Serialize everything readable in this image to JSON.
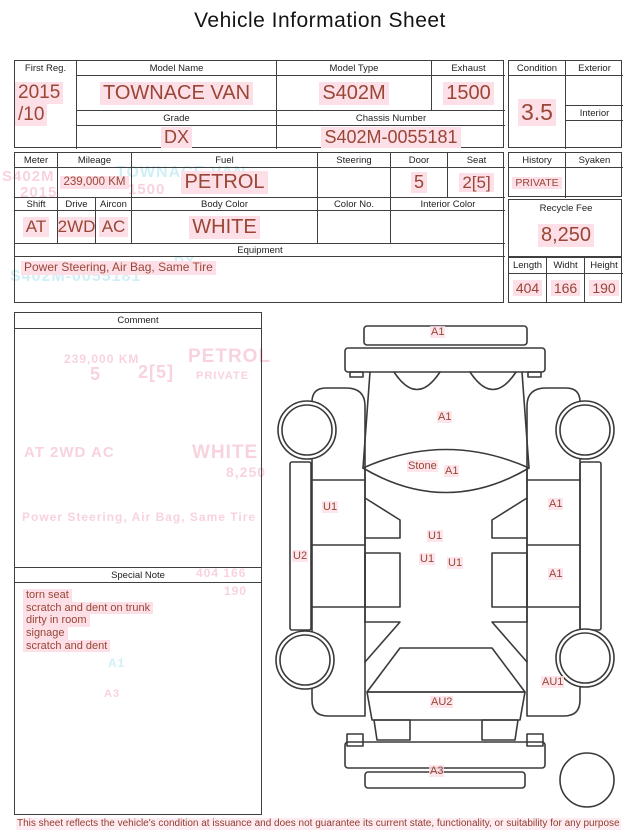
{
  "title": "Vehicle Information Sheet",
  "top_table": {
    "first_reg": {
      "label": "First Reg.",
      "value_line1": "2015",
      "value_line2": "/10"
    },
    "model_name": {
      "label": "Model Name",
      "value": "TOWNACE VAN"
    },
    "model_type": {
      "label": "Model Type",
      "value": "S402M"
    },
    "exhaust": {
      "label": "Exhaust",
      "value": "1500"
    },
    "grade": {
      "label": "Grade",
      "value": "DX"
    },
    "chassis_number": {
      "label": "Chassis Number",
      "value": "S402M-0055181"
    },
    "condition": {
      "label": "Condition",
      "value": "3.5"
    },
    "exterior": {
      "label": "Exterior",
      "value": ""
    },
    "interior": {
      "label": "Interior",
      "value": ""
    }
  },
  "spec_table": {
    "meter": {
      "label": "Meter",
      "value": ""
    },
    "mileage": {
      "label": "Mileage",
      "value": "239,000 KM"
    },
    "fuel": {
      "label": "Fuel",
      "value": "PETROL"
    },
    "steering": {
      "label": "Steering",
      "value": ""
    },
    "door": {
      "label": "Door",
      "value": "5"
    },
    "seat": {
      "label": "Seat",
      "value": "2[5]"
    },
    "shift": {
      "label": "Shift",
      "value": "AT"
    },
    "drive": {
      "label": "Drive",
      "value": "2WD"
    },
    "aircon": {
      "label": "Aircon",
      "value": "AC"
    },
    "body_color": {
      "label": "Body Color",
      "value": "WHITE"
    },
    "color_no": {
      "label": "Color No.",
      "value": ""
    },
    "interior_color": {
      "label": "Interior Color",
      "value": ""
    },
    "equipment": {
      "label": "Equipment",
      "value": "Power Steering, Air Bag, Same Tire"
    }
  },
  "right_table": {
    "history": {
      "label": "History",
      "value": "PRIVATE"
    },
    "syaken": {
      "label": "Syaken",
      "value": ""
    },
    "recycle_fee": {
      "label": "Recycle Fee",
      "value": "8,250"
    },
    "length": {
      "label": "Length",
      "value": "404"
    },
    "width": {
      "label": "Widht",
      "value": "166"
    },
    "height": {
      "label": "Height",
      "value": "190"
    }
  },
  "comment": {
    "label": "Comment"
  },
  "special_note": {
    "label": "Special Note",
    "items": [
      "torn seat",
      "scratch and dent on trunk",
      "dirty in room",
      "signage",
      "scratch and dent"
    ]
  },
  "diagram": {
    "labels": [
      {
        "text": "A1",
        "x": 160,
        "y": 16
      },
      {
        "text": "A1",
        "x": 167,
        "y": 101
      },
      {
        "text": "Stone",
        "x": 137,
        "y": 150
      },
      {
        "text": "A1",
        "x": 174,
        "y": 155
      },
      {
        "text": "U1",
        "x": 52,
        "y": 191
      },
      {
        "text": "A1",
        "x": 278,
        "y": 188
      },
      {
        "text": "U1",
        "x": 157,
        "y": 220
      },
      {
        "text": "U1",
        "x": 149,
        "y": 243
      },
      {
        "text": "U1",
        "x": 177,
        "y": 247
      },
      {
        "text": "U2",
        "x": 22,
        "y": 240
      },
      {
        "text": "A1",
        "x": 278,
        "y": 258
      },
      {
        "text": "AU1",
        "x": 271,
        "y": 366
      },
      {
        "text": "AU2",
        "x": 160,
        "y": 386
      },
      {
        "text": "A3",
        "x": 159,
        "y": 455
      }
    ]
  },
  "ghost_lines": [
    {
      "text": "S402M",
      "x": 2,
      "y": 168,
      "size": 15,
      "color": "pink"
    },
    {
      "text": "2015",
      "x": 20,
      "y": 184,
      "size": 15,
      "color": "pink"
    },
    {
      "text": "TOWNACE VAN",
      "x": 116,
      "y": 164,
      "size": 16,
      "color": "cyan"
    },
    {
      "text": "1500",
      "x": 128,
      "y": 181,
      "size": 15,
      "color": "pink"
    },
    {
      "text": "DX",
      "x": 174,
      "y": 253,
      "size": 14,
      "color": "cyan"
    },
    {
      "text": "S402M-0055181",
      "x": 10,
      "y": 268,
      "size": 16,
      "color": "cyan"
    },
    {
      "text": "239,000 KM",
      "x": 64,
      "y": 352,
      "size": 12,
      "color": "pink"
    },
    {
      "text": "5",
      "x": 90,
      "y": 364,
      "size": 18,
      "color": "pink"
    },
    {
      "text": "2[5]",
      "x": 138,
      "y": 362,
      "size": 18,
      "color": "pink"
    },
    {
      "text": "PETROL",
      "x": 188,
      "y": 346,
      "size": 19,
      "color": "pink"
    },
    {
      "text": "PRIVATE",
      "x": 196,
      "y": 370,
      "size": 11,
      "color": "pink"
    },
    {
      "text": "AT  2WD  AC",
      "x": 24,
      "y": 444,
      "size": 15,
      "color": "pink"
    },
    {
      "text": "WHITE",
      "x": 192,
      "y": 442,
      "size": 19,
      "color": "pink"
    },
    {
      "text": "8,250",
      "x": 226,
      "y": 464,
      "size": 14,
      "color": "pink"
    },
    {
      "text": "Power Steering, Air Bag, Same Tire",
      "x": 22,
      "y": 510,
      "size": 12,
      "color": "pink"
    },
    {
      "text": "404  166",
      "x": 196,
      "y": 566,
      "size": 12,
      "color": "pink"
    },
    {
      "text": "190",
      "x": 224,
      "y": 584,
      "size": 12,
      "color": "pink"
    },
    {
      "text": "A1",
      "x": 108,
      "y": 656,
      "size": 12,
      "color": "cyan"
    },
    {
      "text": "A3",
      "x": 104,
      "y": 688,
      "size": 11,
      "color": "pink"
    }
  ],
  "footer": {
    "disclaimer": "This sheet reflects the vehicle's condition at issuance and does not guarantee its current state, functionality, or suitability for any purpose"
  },
  "colors": {
    "value_text": "#9a4636",
    "highlight": "#fcdfe7",
    "border": "#3f3f3f",
    "ghost_pink": "#f3aec2",
    "ghost_cyan": "#a9e2f0",
    "footer_text": "#943b2c"
  }
}
